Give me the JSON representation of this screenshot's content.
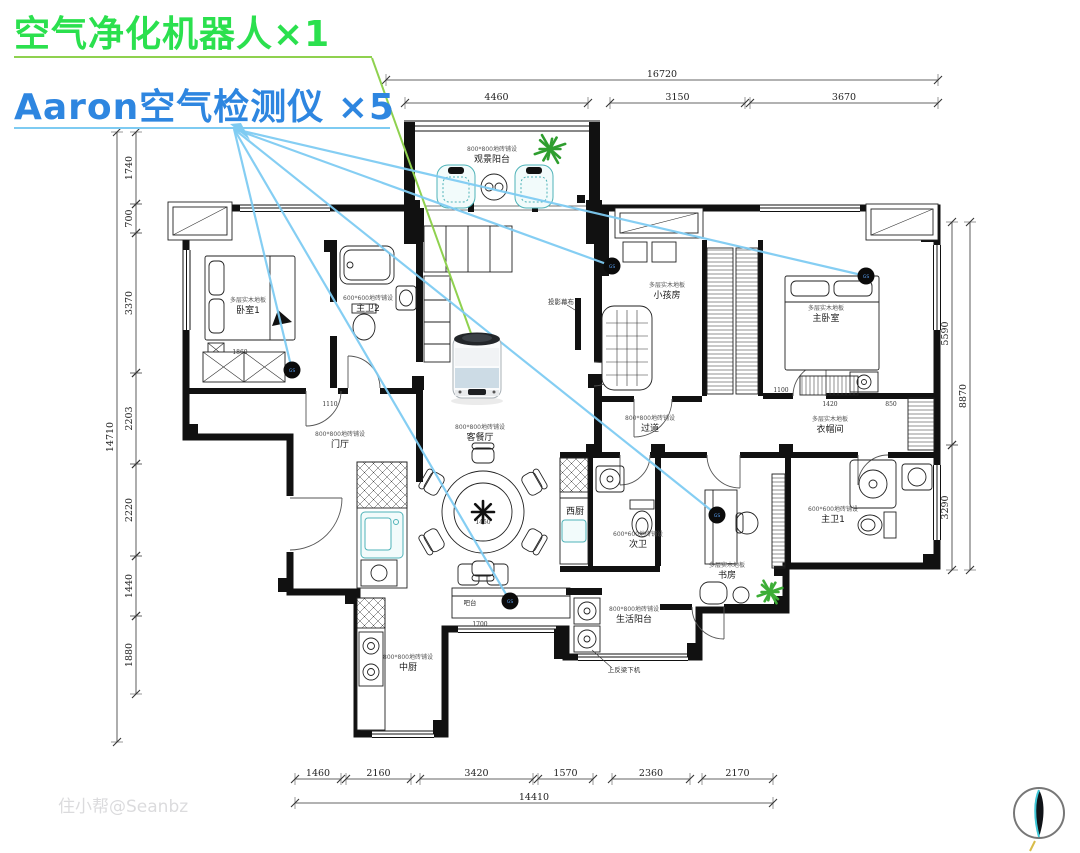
{
  "legend": {
    "purifier_label": "空气净化机器人×1",
    "purifier_color": "#2be04e",
    "purifier_line_color": "#8fd14f",
    "detector_label": "Aaron空气检测仪 ×5",
    "detector_color": "#2e86e0",
    "detector_line_color": "#7ecbf2"
  },
  "watermark": "住小帮@Seanbz",
  "dimensions": {
    "top": {
      "overall": {
        "label": "16720",
        "x1": 386,
        "x2": 938,
        "y": 80
      },
      "segments_y": 103,
      "segments": [
        {
          "label": "4460",
          "x1": 405,
          "x2": 588
        },
        {
          "label": "3150",
          "x1": 610,
          "x2": 745
        },
        {
          "label": "3670",
          "x1": 750,
          "x2": 938
        }
      ]
    },
    "bottom": {
      "overall": {
        "label": "14410",
        "x1": 295,
        "x2": 773,
        "y": 803
      },
      "segments_y": 779,
      "segments": [
        {
          "label": "1460",
          "x1": 295,
          "x2": 341
        },
        {
          "label": "2160",
          "x1": 346,
          "x2": 411
        },
        {
          "label": "3420",
          "x1": 420,
          "x2": 533
        },
        {
          "label": "1570",
          "x1": 538,
          "x2": 593
        },
        {
          "label": "2360",
          "x1": 612,
          "x2": 690
        },
        {
          "label": "2170",
          "x1": 702,
          "x2": 773
        }
      ]
    },
    "left": {
      "overall": {
        "label": "14710",
        "x": 117,
        "y1": 132,
        "y2": 742
      },
      "segments_x": 136,
      "segments": [
        {
          "label": "1740",
          "y1": 132,
          "y2": 204
        },
        {
          "label": "700",
          "y1": 204,
          "y2": 233
        },
        {
          "label": "3370",
          "y1": 233,
          "y2": 373
        },
        {
          "label": "2203",
          "y1": 373,
          "y2": 464
        },
        {
          "label": "2220",
          "y1": 464,
          "y2": 556
        },
        {
          "label": "1440",
          "y1": 556,
          "y2": 616
        },
        {
          "label": "1880",
          "y1": 616,
          "y2": 694
        }
      ]
    },
    "right": {
      "overall": {
        "label": "8870",
        "x": 970,
        "y1": 222,
        "y2": 570
      },
      "segments_x": 952,
      "segments": [
        {
          "label": "5590",
          "y1": 222,
          "y2": 445
        },
        {
          "label": "3290",
          "y1": 445,
          "y2": 570
        }
      ]
    }
  },
  "rooms": [
    {
      "name": "观景阳台",
      "floor": "800*800地砖铺设",
      "x": 492,
      "y": 162
    },
    {
      "name": "卧室1",
      "floor": "多层实木地板",
      "x": 248,
      "y": 313
    },
    {
      "name": "主卫2",
      "floor": "600*600地砖铺设",
      "x": 368,
      "y": 311
    },
    {
      "name": "小孩房",
      "floor": "多层实木地板",
      "x": 667,
      "y": 298
    },
    {
      "name": "主卧室",
      "floor": "多层实木地板",
      "x": 826,
      "y": 321
    },
    {
      "name": "过道",
      "floor": "800*800地砖铺设",
      "x": 650,
      "y": 431
    },
    {
      "name": "衣帽间",
      "floor": "多层实木地板",
      "x": 830,
      "y": 432
    },
    {
      "name": "客餐厅",
      "floor": "800*800地砖铺设",
      "x": 480,
      "y": 440
    },
    {
      "name": "门厅",
      "floor": "800*800地砖铺设",
      "x": 340,
      "y": 447
    },
    {
      "name": "西厨",
      "floor": "",
      "x": 575,
      "y": 514
    },
    {
      "name": "次卫",
      "floor": "600*600地砖铺设",
      "x": 638,
      "y": 547
    },
    {
      "name": "书房",
      "floor": "多层实木地板",
      "x": 727,
      "y": 578
    },
    {
      "name": "主卫1",
      "floor": "600*600地砖铺设",
      "x": 833,
      "y": 522
    },
    {
      "name": "生活阳台",
      "floor": "800*800地砖铺设",
      "x": 634,
      "y": 622
    },
    {
      "name": "中厨",
      "floor": "800*800地砖铺设",
      "x": 408,
      "y": 670
    }
  ],
  "annotations": [
    {
      "text": "投影幕布",
      "x": 561,
      "y": 304
    },
    {
      "text": "吧台",
      "x": 470,
      "y": 605
    },
    {
      "text": "上反梁下机",
      "x": 624,
      "y": 672
    }
  ],
  "plan_dims": [
    {
      "text": "1860",
      "x": 240,
      "y": 354
    },
    {
      "text": "1110",
      "x": 330,
      "y": 406
    },
    {
      "text": "1450",
      "x": 483,
      "y": 524
    },
    {
      "text": "1700",
      "x": 480,
      "y": 626
    },
    {
      "text": "1100",
      "x": 781,
      "y": 392
    },
    {
      "text": "1420",
      "x": 830,
      "y": 406
    },
    {
      "text": "850",
      "x": 891,
      "y": 406
    }
  ],
  "devices": {
    "purifier": {
      "x": 477,
      "y": 366
    },
    "detector_tag": "GS",
    "detectors": [
      {
        "x": 292,
        "y": 370
      },
      {
        "x": 612,
        "y": 266
      },
      {
        "x": 866,
        "y": 276
      },
      {
        "x": 717,
        "y": 515
      },
      {
        "x": 510,
        "y": 601
      }
    ]
  },
  "leaders": {
    "green_underline": {
      "x1": 14,
      "y1": 57,
      "x2": 372,
      "y2": 57
    },
    "green": {
      "x1": 372,
      "y1": 58,
      "x2": 477,
      "y2": 350
    },
    "blue_underline": {
      "x1": 14,
      "y1": 128,
      "x2": 390,
      "y2": 128
    },
    "blue_origin": {
      "x": 234,
      "y": 129
    }
  }
}
